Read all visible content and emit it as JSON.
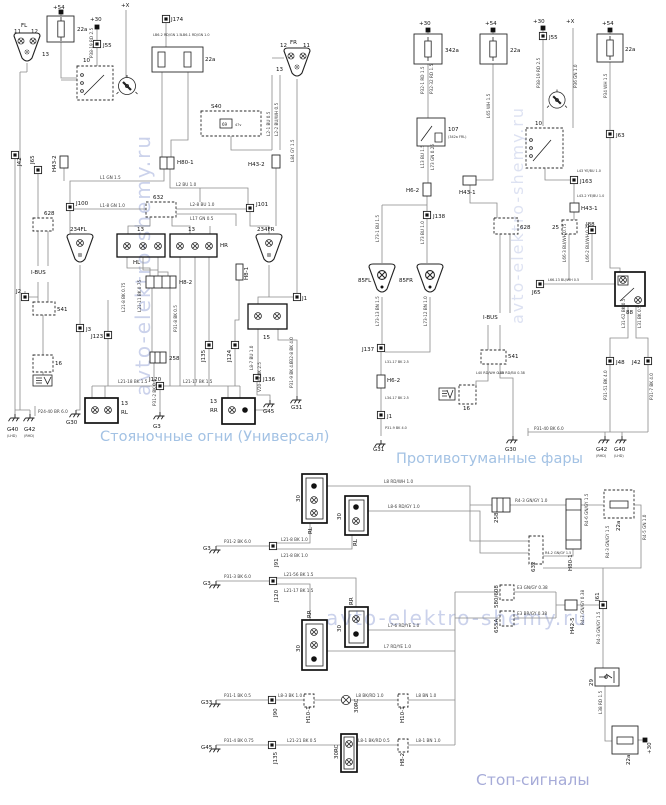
{
  "titles": {
    "parking": "Стояночные огни (Универсал)",
    "fog": "Противотуманные фары",
    "brake": "Стоп-сигналы"
  },
  "watermark": {
    "text": "avto-elektro-shemy.ru"
  },
  "pw": {
    "p30": "+30",
    "p54": "+54",
    "px": "+X"
  },
  "p": {
    "fl": "FL",
    "fr": "FR",
    "p11": "11",
    "p12": "12",
    "p13": "13",
    "f22a": "22a",
    "j55": "J55",
    "n10": "10",
    "j174": "J174",
    "lb62": "LB6-2 RD/GN 1.5",
    "lb61": "LB6-1 RD/GN 1.0",
    "s40": "S40",
    "n69": "69",
    "v47": "47v",
    "h801": "H80-1",
    "h432": "H43-2",
    "j100": "J100",
    "j101": "J101",
    "n632": "632",
    "fl234": "234FL",
    "fr234": "234FR",
    "hl": "HL",
    "hr": "HR",
    "h82": "H8-2",
    "h81": "H8-1",
    "j1": "J1",
    "n15": "15",
    "j3": "J3",
    "j123": "J123",
    "n258": "258",
    "j135": "J135",
    "j124": "J124",
    "j120": "J120",
    "j136": "J136",
    "rl": "RL",
    "rr": "RR",
    "g3": "G3",
    "g45": "G45",
    "g31": "G31",
    "g40": "G40",
    "g42": "G42",
    "g30": "G30",
    "lhd": "(LHD)",
    "rhd": "(RHD)",
    "j42": "J42",
    "j65": "J65",
    "n628": "628",
    "ibus": "I-BUS",
    "j2": "J2",
    "n541": "541",
    "n16": "16"
  },
  "f": {
    "f342a": "342a",
    "f22a": "22a",
    "n107": "107",
    "frl": "(342a FRL)",
    "h62": "H6-2",
    "h431": "H43-1",
    "j55": "J55",
    "j63": "J63",
    "n10": "10",
    "j163": "J163",
    "n25": "25",
    "j88": "J88",
    "n628": "628",
    "j65": "J65",
    "ibus": "I-BUS",
    "n88": "88",
    "j138": "J138",
    "fl85": "85FL",
    "fr85": "85FR",
    "j137": "J137",
    "j1": "J1",
    "g31": "G31",
    "n541": "541",
    "n16": "16",
    "g30": "G30",
    "j48": "J48",
    "j42": "J42",
    "g42": "G42",
    "g40": "G40",
    "rhd": "(RHD)",
    "lhd": "(LHD)"
  },
  "b": {
    "rl": "RL",
    "rr": "RR",
    "n30": "30",
    "rc30": "30RC",
    "g3": "G3",
    "j91": "J91",
    "j120": "J120",
    "n258": "258",
    "h801": "H80-1",
    "f22a": "22a",
    "n632": "632",
    "n580": "580/608",
    "n655a": "655A",
    "h425": "H42-5",
    "j61": "J61",
    "n29": "29",
    "g33": "G33",
    "j90": "J90",
    "h101": "H10-1",
    "g45": "G45",
    "j135": "J135",
    "h82": "H8-2"
  },
  "w": {
    "p": [
      "P38-19 RD 2.5",
      "L1 GN 1.5",
      "L1-8 GN 1.0",
      "L2 BU 1.0",
      "L2-8 BU 1.0",
      "L17 GN 0.5",
      "L2-1 BU 0.5",
      "L2-2 BU/WH 0.5",
      "L21-8 BK 0.75",
      "L21-11 BK 0.75",
      "L21-18 BK 1.5",
      "L21-17 BK 1.5",
      "P31-2 BK 0.5",
      "P31-9 BK 4.0",
      "P24-40 BR 6.0",
      "V20-19 BK 2.5",
      "L8-7 BU 1.0",
      "P31-8 BK 0.5",
      "L84 GY 1.5",
      "P32-8 BK 4.0"
    ],
    "f": [
      "P32-1 RD 1.5",
      "P32-32 RD 1.5",
      "L65 WH 1.5",
      "L13 BU 1.5",
      "L73 GN 0.25",
      "P38-19 RD 2.5",
      "P36 GN 1.0",
      "P34 WH 1.5",
      "L43 YE/BU 1.0",
      "L43-2 YE/BU 1.0",
      "L66-3 BU/WH 0.75",
      "L66-2 BU/WH 0.75",
      "L66-13 BU/WH 0.5",
      "L73-1 BU 1.5",
      "L73 BU 1.0",
      "L73-13 BN 1.5",
      "L73-12 BN 1.0",
      "L31-17 BK 2.5",
      "L34-17 BK 2.5",
      "P31-9 BK 4.0",
      "L40 RD/WH 0.35",
      "L40 RD/BU 0.38",
      "L31-62 BK 0.5",
      "L31 BK 0.5",
      "P31-51 BK 4.0",
      "P31-7 BK 4.0",
      "P31-40 BK 6.0"
    ],
    "b": [
      "L8 RD/WH 1.0",
      "L8-6 RD/GY 1.0",
      "L21-8 BK 1.0",
      "L21-8 BK 1.0",
      "L21-56 BK 1.5",
      "L21-17 BK 1.5",
      "P31-2 BK 6.0",
      "P31-3 BK 6.0",
      "L7-6 RD/YE 1.0",
      "L7 RD/YE 1.0",
      "R4-3 GN/GY 1.0",
      "R4-6 GN/GY 1.5",
      "R4-5 GN 1.0",
      "R4-2 GN/GY 1.5",
      "R4-3 GN/GY 1.5",
      "E3 GN/GY 0.38",
      "E3 BR/GY 0.38",
      "R4-7 GN/GY 0.38",
      "R4-3 GN/GY 1.5",
      "L38 RD 1.5",
      "P31-1 BK 0.5",
      "L8-3 BK 1.0",
      "L8 BK/RD 1.0",
      "L8 BN 1.0",
      "P31-4 BK 0.75",
      "L21-21 BK 0.5",
      "L8-1 BK/RD 0.5",
      "L8-1 BN 1.0"
    ]
  }
}
